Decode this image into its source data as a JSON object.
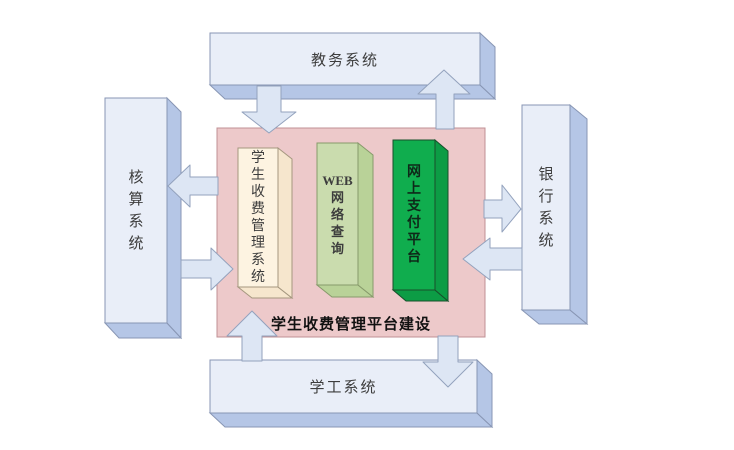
{
  "diagram": {
    "outer_systems": {
      "top": {
        "label": "教务系统"
      },
      "left": {
        "label": "核算系统",
        "lines": [
          "核",
          "算",
          "系",
          "统"
        ]
      },
      "right": {
        "label": "银行系统",
        "lines": [
          "银",
          "行",
          "系",
          "统"
        ]
      },
      "bottom": {
        "label": "学工系统"
      }
    },
    "platform": {
      "title": "学生收费管理平台建设",
      "components": [
        {
          "name": "学生收费管理系统",
          "lines": [
            "学",
            "生",
            "收",
            "费",
            "管",
            "理",
            "系",
            "统"
          ],
          "fill": "#fdf3e1"
        },
        {
          "name": "WEB网络查询",
          "lines": [
            "WEB",
            "网",
            "络",
            "查",
            "询"
          ],
          "fill": "#cadcae"
        },
        {
          "name": "网上支付平台",
          "lines": [
            "网",
            "上",
            "支",
            "付",
            "平",
            "台"
          ],
          "fill": "#10ad4e"
        }
      ]
    },
    "arrows": [
      {
        "between": "教务系统-平台",
        "directions": [
          "down",
          "up"
        ]
      },
      {
        "between": "核算系统-平台",
        "directions": [
          "left",
          "right"
        ]
      },
      {
        "between": "银行系统-平台",
        "directions": [
          "right",
          "left"
        ]
      },
      {
        "between": "学工系统-平台",
        "directions": [
          "up",
          "down"
        ]
      }
    ],
    "colors": {
      "system_box_front": "#e9eef8",
      "system_box_side": "#b5c6e6",
      "system_box_border": "#8896b4",
      "arrow_fill": "#dde6f4",
      "arrow_border": "#93a2bd",
      "platform_panel": "#edc9ca",
      "platform_panel_border": "#c09094",
      "component1_side": "#f6e6cd",
      "component2_side": "#b9d298",
      "component3_side": "#0c9c45"
    }
  }
}
